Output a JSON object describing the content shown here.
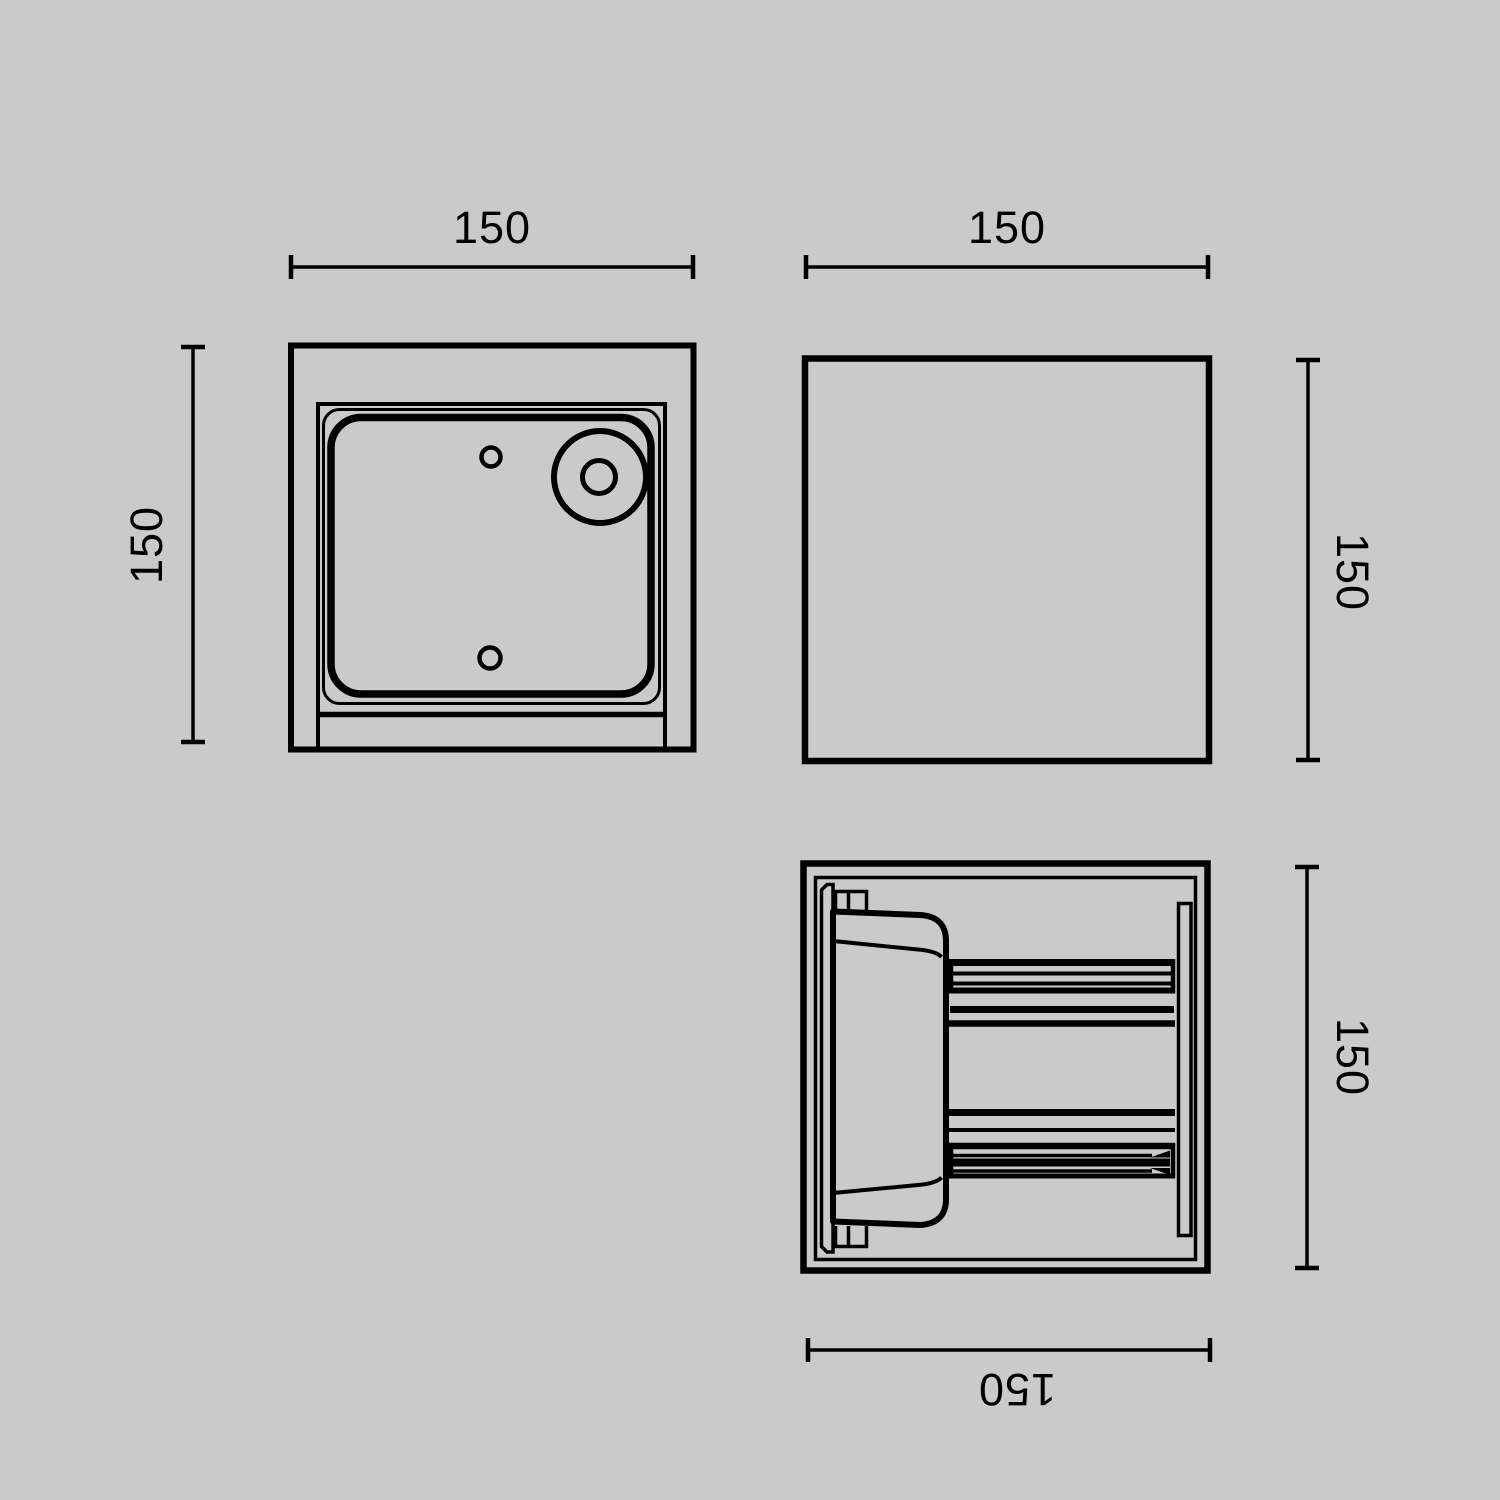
{
  "drawing": {
    "title": "cube wall light dimensional drawing",
    "views": [
      {
        "id": "back-view",
        "position": "top-left",
        "width_label": "150",
        "height_label": "150"
      },
      {
        "id": "side-view",
        "position": "top-right",
        "width_label": "150",
        "height_label": "150"
      },
      {
        "id": "top-view",
        "position": "bottom-right",
        "height_label": "150",
        "depth_label": "150"
      }
    ]
  },
  "dimensions": {
    "back_width": "150",
    "back_height": "150",
    "side_width": "150",
    "side_height": "150",
    "top_height": "150",
    "top_depth": "150"
  },
  "colors": {
    "background": "#cacaca",
    "line": "#000000"
  }
}
